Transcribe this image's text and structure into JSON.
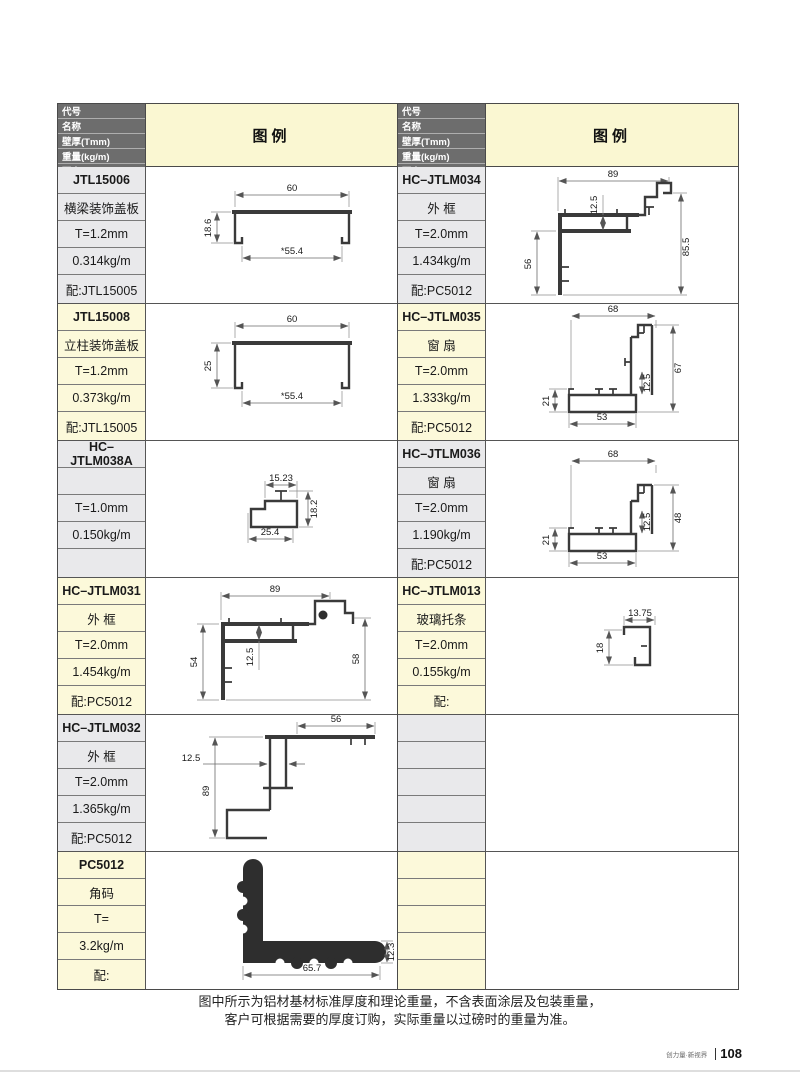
{
  "header": {
    "rows": [
      "代号",
      "名称",
      "壁厚(Tmm)",
      "重量(kg/m)",
      "配套"
    ],
    "legend": "图例"
  },
  "profiles": {
    "left": [
      {
        "code": "JTL15006",
        "name": "横梁装饰盖板",
        "thickness": "T=1.2mm",
        "weight": "0.314kg/m",
        "match": "配:JTL15005",
        "dims": {
          "top": "60",
          "left": "18.6",
          "inner": "*55.4"
        }
      },
      {
        "code": "JTL15008",
        "name": "立柱装饰盖板",
        "thickness": "T=1.2mm",
        "weight": "0.373kg/m",
        "match": "配:JTL15005",
        "dims": {
          "top": "60",
          "left": "25",
          "inner": "*55.4"
        }
      },
      {
        "code": "HC–JTLM038A",
        "name": "",
        "thickness": "T=1.0mm",
        "weight": "0.150kg/m",
        "match": "",
        "dims": {
          "top": "15.23",
          "right": "18.2",
          "bottom": "25.4"
        }
      },
      {
        "code": "HC–JTLM031",
        "name": "外 框",
        "thickness": "T=2.0mm",
        "weight": "1.454kg/m",
        "match": "配:PC5012",
        "dims": {
          "top": "89",
          "left": "54",
          "mid": "12.5",
          "right": "58"
        }
      },
      {
        "code": "HC–JTLM032",
        "name": "外 框",
        "thickness": "T=2.0mm",
        "weight": "1.365kg/m",
        "match": "配:PC5012",
        "dims": {
          "top": "56",
          "mid": "12.5",
          "left": "89"
        }
      },
      {
        "code": "PC5012",
        "name": "角码",
        "thickness": "T=",
        "weight": "3.2kg/m",
        "match": "配:",
        "dims": {
          "bottom": "65.7",
          "right": "12.3"
        }
      }
    ],
    "right": [
      {
        "code": "HC–JTLM034",
        "name": "外 框",
        "thickness": "T=2.0mm",
        "weight": "1.434kg/m",
        "match": "配:PC5012",
        "dims": {
          "top": "89",
          "mid": "12.5",
          "right": "85.5",
          "left": "56"
        }
      },
      {
        "code": "HC–JTLM035",
        "name": "窗 扇",
        "thickness": "T=2.0mm",
        "weight": "1.333kg/m",
        "match": "配:PC5012",
        "dims": {
          "top": "68",
          "right": "67",
          "mid": "12.5",
          "left": "21",
          "bottom": "53"
        }
      },
      {
        "code": "HC–JTLM036",
        "name": "窗 扇",
        "thickness": "T=2.0mm",
        "weight": "1.190kg/m",
        "match": "配:PC5012",
        "dims": {
          "top": "68",
          "right": "48",
          "mid": "12.5",
          "left": "21",
          "bottom": "53"
        }
      },
      {
        "code": "HC–JTLM013",
        "name": "玻璃托条",
        "thickness": "T=2.0mm",
        "weight": "0.155kg/m",
        "match": "配:",
        "dims": {
          "top": "13.75",
          "left": "18"
        }
      },
      {
        "code": "",
        "name": "",
        "thickness": "",
        "weight": "",
        "match": "",
        "dims": {}
      },
      {
        "code": "",
        "name": "",
        "thickness": "",
        "weight": "",
        "match": "",
        "dims": {}
      }
    ]
  },
  "footer": {
    "line1": "图中所示为铝材基材标准厚度和理论重量，不含表面涂层及包装重量，",
    "line2": "客户可根据需要的厚度订购，实际重量以过磅时的重量为准。"
  },
  "page": {
    "slogan": "创力量·新视界",
    "number": "108"
  },
  "colors": {
    "header_gray": "#6d6d6d",
    "legend_yellow": "#faf7d2",
    "cell_gray": "#e9e9eb",
    "cell_yellow": "#fcf9da"
  }
}
